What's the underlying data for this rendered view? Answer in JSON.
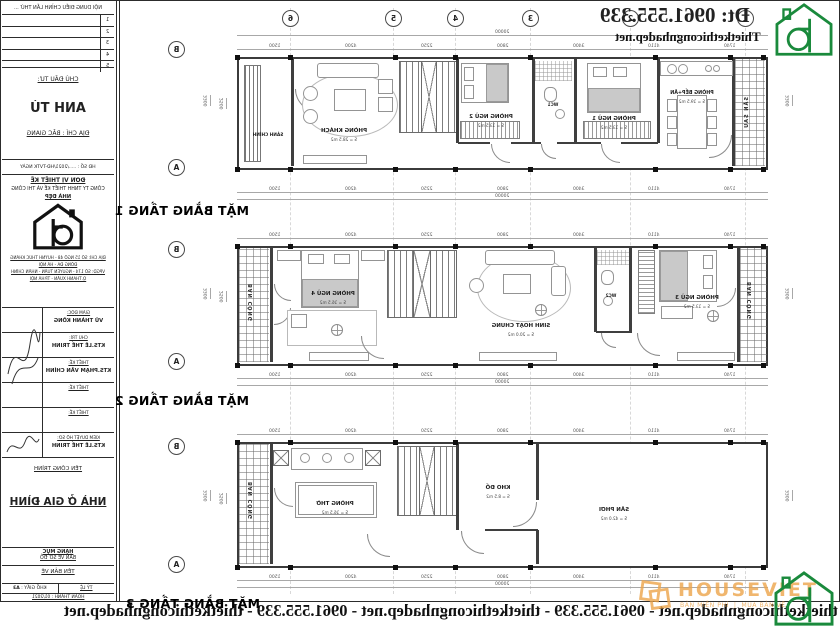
{
  "brand": {
    "phone": "Đt: 0961.555.339",
    "website": "Thietkethicongnhadep.net",
    "banner": "thietkethicongnhadep.net - 0961.555.339 - thietkethicongnhadep.net - 0961.555.339 - thietkethicongnhadep.net",
    "accent_green": "#1a8a3c",
    "accent_maroon": "#7b2222",
    "watermark": {
      "name": "HOUSEVIET",
      "tag1": "BẢN MIỄN PHÍ",
      "tag2": "MUA BẢN VẼ",
      "color": "#eda54b"
    }
  },
  "grid": {
    "cols": [
      "6",
      "5",
      "4",
      "3",
      "2",
      "1"
    ],
    "rows": [
      "B",
      "A"
    ]
  },
  "dims": {
    "total": "20000",
    "segments": [
      "1500",
      "4200",
      "2250",
      "2800",
      "3400",
      "4110",
      "1740"
    ],
    "width_total": "3300",
    "width_inner": "2500"
  },
  "plans": [
    {
      "title": "MẶT BẰNG TẦNG 1",
      "rooms": {
        "sanh": {
          "name": "SẢNH CHÍNH"
        },
        "khach": {
          "name": "PHÒNG KHÁCH",
          "area": "S = 28.5 m2"
        },
        "pn2": {
          "name": "PHÒNG NGỦ 2",
          "area": "S = 13.5 m2"
        },
        "wc1": {
          "name": "WC1",
          "area": "S = 3.2 m2"
        },
        "pn1": {
          "name": "PHÒNG NGỦ 1",
          "area": "S = 13.5 m2"
        },
        "bep": {
          "name": "PHÒNG BẾP+ĂN",
          "area": "S = 19.5 m2"
        },
        "sansau": {
          "name": "SÂN SAU"
        }
      }
    },
    {
      "title": "MẶT BẰNG TẦNG 2",
      "rooms": {
        "bancong1": {
          "name": "BAN CÔNG"
        },
        "pn4": {
          "name": "PHÒNG NGỦ 4",
          "area": "S = 16.5 m2"
        },
        "shc": {
          "name": "SINH HOẠT CHUNG",
          "area": "S = 20.0 m2"
        },
        "wc2": {
          "name": "WC2",
          "area": "S = 4.5 m2"
        },
        "pn3": {
          "name": "PHÒNG NGỦ 3",
          "area": "S = 13.5 m2"
        },
        "bancong2": {
          "name": "BAN CÔNG"
        }
      }
    },
    {
      "title": "MẶT BẰNG TẦNG 3",
      "rooms": {
        "bancong": {
          "name": "BAN CÔNG"
        },
        "tho": {
          "name": "PHÒNG THỜ",
          "area": "S = 16.5 m2"
        },
        "kho": {
          "name": "KHO ĐỒ",
          "area": "S = 8.5 m2"
        },
        "phoi": {
          "name": "SÂN PHƠI",
          "area": "S = 42.0 m2"
        }
      }
    }
  ],
  "titleblock": {
    "revision": {
      "header": "NỘI DUNG ĐIỀU CHỈNH LẦN THỨ ...",
      "rows": [
        "1",
        "2",
        "3",
        "4",
        "5"
      ]
    },
    "investor": {
      "label": "CHỦ ĐẦU TƯ:",
      "name": "ANH TÚ",
      "address": "ĐỊA CHỈ : BẮC GIANG"
    },
    "contract": "HĐ SỐ : ...../2021/HĐ-TVTK NGÀY",
    "designer": {
      "label": "ĐƠN VỊ THIẾT KẾ",
      "company": "CÔNG TY TNHH THIẾT KẾ VÀ THI CÔNG",
      "company2": "NHÀ ĐẸP",
      "addr1": "ĐỊA CHỈ: SỐ 15 NGÕ 48 - HUỲNH THÚC KHÁNG",
      "addr2": "ĐỐNG ĐA - HÀ NỘI",
      "addr3": "VPGD: SỐ 174 - NGUYỄN TUÂN - NHÂN CHÍNH",
      "addr4": "Q.THANH XUÂN - TP.HÀ NỘI"
    },
    "personnel": [
      {
        "role": "GIÁM ĐỐC:",
        "name": "VŨ THÀNH KÔNG"
      },
      {
        "role": "CHỦ TRÌ:",
        "name": "KTS.LÊ THẾ TRINH"
      },
      {
        "role": "THIẾT KẾ:",
        "name": "KTS.PHẠM VĂN CHÍNH"
      },
      {
        "role": "THIẾT KẾ:",
        "name": ""
      },
      {
        "role": "THIẾT KẾ:",
        "name": ""
      },
      {
        "role": "KIỂM DUYỆT HỒ SƠ:",
        "name": "KTS.LÊ THẾ TRINH"
      }
    ],
    "project": {
      "label": "TÊN CÔNG TRÌNH",
      "name": "NHÀ Ở GIA ĐÌNH"
    },
    "category": {
      "label": "HẠNG MỤC",
      "value": "BẢN VẼ SƠ ĐỒ"
    },
    "sheet": {
      "label": "TÊN BẢN VẼ"
    },
    "footer": {
      "scale_label": "TỶ LỆ",
      "paper_label": "KHỔ GIẤY :",
      "paper": "A3",
      "completed": "HOÀN THÀNH : 01/2021"
    }
  }
}
